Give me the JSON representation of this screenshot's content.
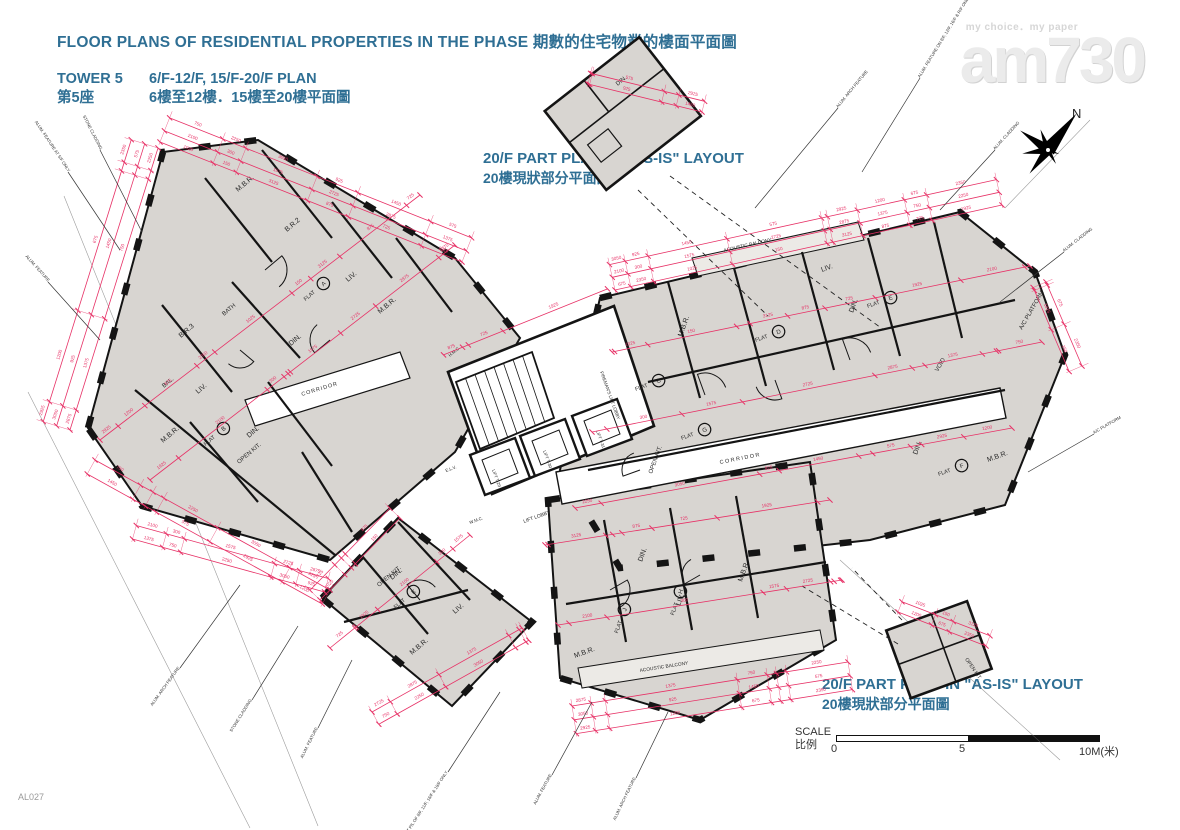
{
  "header": {
    "title": "FLOOR PLANS OF RESIDENTIAL PROPERTIES IN THE PHASE 期數的住宅物業的樓面平面圖",
    "tower_en": "TOWER 5",
    "floors_en": "6/F-12/F, 15/F-20/F PLAN",
    "tower_zh": "第5座",
    "floors_zh": "6樓至12樓．15樓至20樓平面圖"
  },
  "watermark": {
    "tagline": "my choice．my paper",
    "logo": "am730"
  },
  "north": {
    "label": "N"
  },
  "part_plan": {
    "en": "20/F PART PLAN IN \"AS-IS\" LAYOUT",
    "zh": "20樓現狀部分平面圖"
  },
  "scale_bar": {
    "label_en": "SCALE",
    "label_zh": "比例",
    "tick_0": "0",
    "tick_5": "5",
    "tick_10": "10M(米)"
  },
  "doc_code": "AL027",
  "labels": {
    "mbr": "M.B.R.",
    "br2": "B.R.2",
    "br3": "B.R.3",
    "bath": "BATH",
    "liv": "LIV.",
    "din": "DIN.",
    "open_kit": "OPEN KIT.",
    "bal": "BAL.",
    "corridor": "CORRIDOR",
    "flat": "FLAT",
    "lift_lobby": "LIFT LOBBY",
    "fireman_lobby": "FIREMAN'S LIFT LOBBY",
    "lift_1": "LIFT T-29",
    "lift_2": "LIFT T-30",
    "lift_3": "LIFT T-31",
    "acoustic_balcony": "ACOUSTIC BALCONY",
    "void": "VOID",
    "ac_platform": "A/C PLATFORM",
    "wmc": "W.M.C.",
    "hmc": "H.M.C.",
    "elv": "E.L.V."
  },
  "letters": {
    "a": "A",
    "b": "B",
    "c": "C",
    "d": "D",
    "e": "E",
    "f": "F",
    "g": "G",
    "h": "H",
    "j": "J",
    "k": "K"
  },
  "perimeter_labels": [
    "ALUM. ARCH FEATURE",
    "ALUM. CLADDING",
    "STONE CLADDING",
    "ALUM. FEATURE",
    "ALUM. FEATURE AT 5/F ONLY",
    "ALUM. FEATURE AT P/L OF 8/F, 11/F, 16/F & 19/F ONLY",
    "ALUM. FEATURE ON 8/F, 12/F, 16/F & R/F ONLY",
    "A/C PLATFORM"
  ],
  "dims": [
    "2875",
    "1375",
    "750",
    "2250",
    "3050",
    "925",
    "1450",
    "575",
    "2925",
    "1200",
    "675",
    "2350",
    "1025",
    "150",
    "3125",
    "875",
    "725",
    "1925",
    "2100",
    "300",
    "1575",
    "2725"
  ],
  "colors": {
    "dim_line": "#e73166",
    "wall": "#141414",
    "room_fill": "#d8d5d1",
    "heading": "#2f6f94"
  }
}
